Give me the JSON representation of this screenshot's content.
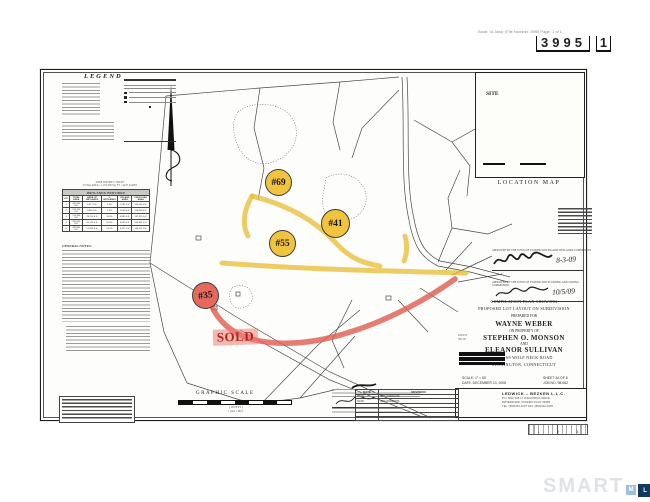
{
  "page": {
    "header_note": "Book: 41 Map: (File Number: 3995 Page: 1 of 1",
    "stamp_number": "3995",
    "stamp_suffix": "1"
  },
  "legend": {
    "title": "LEGEND"
  },
  "wetlands_table": {
    "pre_line1": "ZONE DISTRICT \"RR-80\"",
    "pre_line2": "TOTAL AREA = 1,074,500 SQ. FT. / 24.67 ACRES",
    "title": "WETLANDS PROVIDED",
    "columns": [
      "LOT",
      "TOTAL AREA",
      "AREA OF WETLANDS",
      "% WETLANDS",
      "UPLAND AREA",
      "PROPOSED AREA"
    ],
    "rows": [
      [
        "1",
        "150,282 S.F.",
        "5,917 S.F.",
        "3.9%",
        "1,282 S.F.",
        "144,365 S.F."
      ],
      [
        "2",
        "132,256 S.F.",
        "3,862 S.F.",
        "2.9%",
        "1,059 S.F.",
        "128,394 S.F."
      ],
      [
        "3",
        "176,330 S.F.",
        "29,210 S.F.",
        "16.6%",
        "4,885 S.F.",
        "147,120 S.F."
      ],
      [
        "4",
        "185,065 S.F.",
        "20,174 S.F.",
        "10.9%",
        "3,653 S.F.",
        "164,891 S.F."
      ],
      [
        "5",
        "192,861 S.F.",
        "27,850 S.F.",
        "14.4%",
        "4,957 S.F.",
        "165,011 S.F."
      ]
    ]
  },
  "notes": {
    "title": "GENERAL NOTES:"
  },
  "lots": [
    {
      "label": "#69",
      "color": "yellow"
    },
    {
      "label": "#41",
      "color": "yellow"
    },
    {
      "label": "#55",
      "color": "yellow"
    },
    {
      "label": "#35",
      "color": "red"
    }
  ],
  "sold_label": "SOLD",
  "location_map": {
    "site_label": "SITE",
    "caption": "LOCATION MAP"
  },
  "approvals": [
    {
      "text": "APPROVED BY THE TOWN OF STONINGTON INLAND WETLANDS COMMISSION",
      "date": "8-3-09"
    },
    {
      "text": "APPROVED BY THE TOWN OF STONINGTON PLANNING AND ZONING COMMISSION",
      "date": "10/5/09"
    }
  ],
  "title_block": {
    "line1": "COMPILATION PLAN SHOWING",
    "line2": "PROPOSED LOT LAYOUT ON SUBDIVISION",
    "line3": "PREPARED FOR",
    "client": "WAYNE WEBER",
    "line5": "ON PROPERTY OF",
    "owner1": "STEPHEN O. MONSON",
    "and": "AND",
    "owner2": "ELEANOR SULLIVAN",
    "address": "33 & 69 WOLF NECK ROAD",
    "town": "STONINGTON, CONNECTICUT",
    "scale": "SCALE: 1\" = 80'",
    "date": "DATE: DECEMBER 10, 2008",
    "sheet": "SHEET 3A OF 8",
    "job": "JOB NO. 98-062",
    "ref1": "#31933",
    "ref2": "S0118"
  },
  "firm": {
    "name": "LEDWICK – BEZKEN  L.L.C.",
    "addr1": "P.O. BOX 528   17 INDUSTRIAL DRIVE",
    "addr2": "WATERFORD, CONNECTICUT 06385",
    "addr3": "TEL. (860)442-1207   FAX. (860)442-0295"
  },
  "graphic_scale": {
    "title": "GRAPHIC SCALE",
    "sub1": "( IN FEET )",
    "sub2": "1 inch = 80 ft."
  },
  "revision_table": {
    "columns": [
      "DATE",
      "REVISION"
    ],
    "rows": [
      [
        "1/5/09",
        "PER COMMENTS"
      ],
      [
        "3/4/09",
        "PER COMMENTS"
      ],
      [
        "",
        ""
      ],
      [
        "",
        ""
      ],
      [
        "",
        ""
      ],
      [
        "",
        ""
      ]
    ]
  },
  "ruler": {
    "marks": [
      "1",
      "2",
      "3"
    ]
  },
  "watermark": {
    "word": "SMART",
    "m": "M",
    "l": "L",
    "s": "S"
  }
}
